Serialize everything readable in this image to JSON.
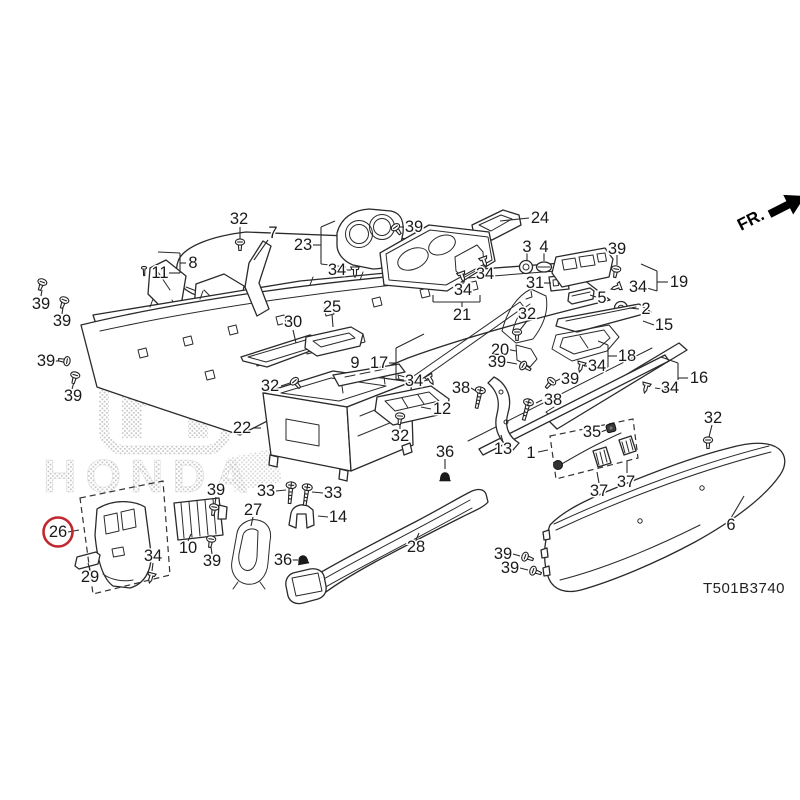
{
  "watermark": {
    "brand": "HONDA"
  },
  "orientation_label": "FR.",
  "diagram_code": "T501B3740",
  "highlighted_part": {
    "number": "26",
    "ring_color": "#c1272d"
  },
  "colors": {
    "line": "#2a2a2a",
    "label": "#1a1a1a",
    "watermark_dot": "#c9c9c9",
    "highlight": "#c1272d"
  },
  "diagram": {
    "labels": [
      {
        "t": "32",
        "x": 239,
        "y": 219
      },
      {
        "t": "7",
        "x": 273,
        "y": 233
      },
      {
        "t": "23",
        "x": 303,
        "y": 245
      },
      {
        "t": "39",
        "x": 414,
        "y": 227
      },
      {
        "t": "24",
        "x": 540,
        "y": 218
      },
      {
        "t": "3",
        "x": 527,
        "y": 247
      },
      {
        "t": "4",
        "x": 544,
        "y": 247
      },
      {
        "t": "39",
        "x": 617,
        "y": 249
      },
      {
        "t": "8",
        "x": 193,
        "y": 263
      },
      {
        "t": "11",
        "x": 160,
        "y": 273
      },
      {
        "t": "34",
        "x": 337,
        "y": 270
      },
      {
        "t": "34",
        "x": 485,
        "y": 274
      },
      {
        "t": "19",
        "x": 679,
        "y": 282
      },
      {
        "t": "31",
        "x": 535,
        "y": 283
      },
      {
        "t": "34",
        "x": 638,
        "y": 287
      },
      {
        "t": "34",
        "x": 463,
        "y": 290
      },
      {
        "t": "5",
        "x": 602,
        "y": 298
      },
      {
        "t": "2",
        "x": 646,
        "y": 309
      },
      {
        "t": "39",
        "x": 41,
        "y": 304
      },
      {
        "t": "25",
        "x": 332,
        "y": 307
      },
      {
        "t": "21",
        "x": 462,
        "y": 315
      },
      {
        "t": "32",
        "x": 527,
        "y": 314
      },
      {
        "t": "39",
        "x": 62,
        "y": 321
      },
      {
        "t": "30",
        "x": 293,
        "y": 322
      },
      {
        "t": "15",
        "x": 664,
        "y": 325
      },
      {
        "t": "20",
        "x": 500,
        "y": 350
      },
      {
        "t": "18",
        "x": 627,
        "y": 356
      },
      {
        "t": "39",
        "x": 46,
        "y": 361
      },
      {
        "t": "9",
        "x": 355,
        "y": 363
      },
      {
        "t": "17",
        "x": 379,
        "y": 363
      },
      {
        "t": "39",
        "x": 497,
        "y": 362
      },
      {
        "t": "34",
        "x": 597,
        "y": 366
      },
      {
        "t": "16",
        "x": 699,
        "y": 378
      },
      {
        "t": "39",
        "x": 570,
        "y": 379
      },
      {
        "t": "34",
        "x": 414,
        "y": 381
      },
      {
        "t": "32",
        "x": 270,
        "y": 386
      },
      {
        "t": "38",
        "x": 461,
        "y": 388
      },
      {
        "t": "34",
        "x": 670,
        "y": 388
      },
      {
        "t": "39",
        "x": 73,
        "y": 396
      },
      {
        "t": "38",
        "x": 553,
        "y": 400
      },
      {
        "t": "12",
        "x": 442,
        "y": 409
      },
      {
        "t": "32",
        "x": 713,
        "y": 418
      },
      {
        "t": "22",
        "x": 242,
        "y": 428
      },
      {
        "t": "35",
        "x": 592,
        "y": 432
      },
      {
        "t": "32",
        "x": 400,
        "y": 436
      },
      {
        "t": "13",
        "x": 503,
        "y": 449
      },
      {
        "t": "36",
        "x": 445,
        "y": 452
      },
      {
        "t": "1",
        "x": 531,
        "y": 453
      },
      {
        "t": "37",
        "x": 626,
        "y": 482
      },
      {
        "t": "37",
        "x": 599,
        "y": 491
      },
      {
        "t": "39",
        "x": 216,
        "y": 490
      },
      {
        "t": "33",
        "x": 266,
        "y": 491
      },
      {
        "t": "33",
        "x": 333,
        "y": 493
      },
      {
        "t": "27",
        "x": 253,
        "y": 510
      },
      {
        "t": "14",
        "x": 338,
        "y": 517
      },
      {
        "t": "6",
        "x": 731,
        "y": 525
      },
      {
        "t": "26",
        "x": 58,
        "y": 532,
        "circled": true
      },
      {
        "t": "28",
        "x": 416,
        "y": 547
      },
      {
        "t": "10",
        "x": 188,
        "y": 548
      },
      {
        "t": "39",
        "x": 503,
        "y": 554
      },
      {
        "t": "34",
        "x": 153,
        "y": 556
      },
      {
        "t": "36",
        "x": 283,
        "y": 560
      },
      {
        "t": "39",
        "x": 510,
        "y": 568
      },
      {
        "t": "29",
        "x": 90,
        "y": 577
      },
      {
        "t": "39",
        "x": 212,
        "y": 561
      }
    ],
    "leaders": [
      [
        240,
        227,
        240,
        240
      ],
      [
        268,
        240,
        254,
        260
      ],
      [
        313,
        245,
        321,
        245
      ],
      [
        321,
        227,
        321,
        264
      ],
      [
        321,
        227,
        335,
        221
      ],
      [
        321,
        264,
        346,
        267
      ],
      [
        404,
        227,
        399,
        227
      ],
      [
        529,
        218,
        500,
        221
      ],
      [
        527,
        253,
        527,
        261
      ],
      [
        544,
        253,
        544,
        261
      ],
      [
        617,
        255,
        617,
        265
      ],
      [
        186,
        263,
        180,
        263
      ],
      [
        180,
        253,
        180,
        273
      ],
      [
        180,
        253,
        158,
        252
      ],
      [
        180,
        273,
        169,
        273
      ],
      [
        346,
        270,
        351,
        270
      ],
      [
        485,
        268,
        485,
        264
      ],
      [
        463,
        284,
        463,
        279
      ],
      [
        433,
        302,
        480,
        302
      ],
      [
        462,
        302,
        462,
        307
      ],
      [
        433,
        302,
        433,
        295
      ],
      [
        480,
        302,
        480,
        295
      ],
      [
        544,
        283,
        551,
        283
      ],
      [
        596,
        297,
        590,
        295
      ],
      [
        639,
        309,
        629,
        308
      ],
      [
        668,
        282,
        657,
        282
      ],
      [
        657,
        271,
        657,
        291
      ],
      [
        657,
        271,
        641,
        264
      ],
      [
        657,
        291,
        647,
        288
      ],
      [
        41,
        296,
        42,
        290
      ],
      [
        62,
        314,
        63,
        307
      ],
      [
        54,
        361,
        60,
        361
      ],
      [
        72,
        389,
        74,
        382
      ],
      [
        654,
        325,
        643,
        321
      ],
      [
        332,
        314,
        333,
        327
      ],
      [
        293,
        330,
        296,
        343
      ],
      [
        527,
        321,
        520,
        330
      ],
      [
        506,
        349,
        516,
        351
      ],
      [
        617,
        356,
        608,
        356
      ],
      [
        608,
        345,
        608,
        367
      ],
      [
        608,
        345,
        598,
        341
      ],
      [
        608,
        367,
        590,
        366
      ],
      [
        506,
        362,
        517,
        364
      ],
      [
        688,
        378,
        678,
        378
      ],
      [
        678,
        363,
        678,
        391
      ],
      [
        678,
        363,
        661,
        357
      ],
      [
        678,
        391,
        655,
        388
      ],
      [
        560,
        379,
        556,
        381
      ],
      [
        281,
        386,
        290,
        383
      ],
      [
        424,
        381,
        428,
        380
      ],
      [
        587,
        366,
        584,
        366
      ],
      [
        471,
        388,
        476,
        391
      ],
      [
        542,
        400,
        536,
        403
      ],
      [
        431,
        409,
        421,
        407
      ],
      [
        253,
        428,
        261,
        428
      ],
      [
        400,
        429,
        400,
        423
      ],
      [
        712,
        425,
        709,
        437
      ],
      [
        601,
        432,
        606,
        430
      ],
      [
        445,
        459,
        445,
        469
      ],
      [
        503,
        442,
        501,
        435
      ],
      [
        538,
        452,
        548,
        450
      ],
      [
        627,
        473,
        627,
        461
      ],
      [
        599,
        483,
        597,
        472
      ],
      [
        216,
        497,
        215,
        504
      ],
      [
        276,
        491,
        286,
        490
      ],
      [
        323,
        493,
        312,
        492
      ],
      [
        253,
        517,
        251,
        526
      ],
      [
        328,
        517,
        318,
        516
      ],
      [
        68,
        532,
        79,
        530
      ],
      [
        188,
        541,
        191,
        534
      ],
      [
        416,
        540,
        419,
        533
      ],
      [
        153,
        563,
        152,
        571
      ],
      [
        292,
        560,
        298,
        560
      ],
      [
        212,
        554,
        211,
        547
      ],
      [
        90,
        570,
        88,
        563
      ],
      [
        731,
        518,
        744,
        496
      ],
      [
        513,
        554,
        520,
        556
      ],
      [
        520,
        568,
        528,
        570
      ],
      [
        389,
        363,
        396,
        363
      ],
      [
        396,
        348,
        396,
        379
      ],
      [
        396,
        348,
        424,
        334
      ],
      [
        396,
        379,
        404,
        380
      ]
    ],
    "fasteners": [
      {
        "t": "screw",
        "x": 240,
        "y": 243,
        "r": 0
      },
      {
        "t": "screw",
        "x": 42,
        "y": 283,
        "r": 20
      },
      {
        "t": "screw",
        "x": 64,
        "y": 301,
        "r": 20
      },
      {
        "t": "screw",
        "x": 66,
        "y": 361,
        "r": 100
      },
      {
        "t": "screw",
        "x": 75,
        "y": 376,
        "r": 15
      },
      {
        "t": "screw",
        "x": 396,
        "y": 228,
        "r": -35
      },
      {
        "t": "screw",
        "x": 616,
        "y": 270,
        "r": 10
      },
      {
        "t": "screw",
        "x": 524,
        "y": 366,
        "r": -60
      },
      {
        "t": "screw",
        "x": 551,
        "y": 382,
        "r": 40
      },
      {
        "t": "screw",
        "x": 214,
        "y": 508,
        "r": 10
      },
      {
        "t": "screw",
        "x": 211,
        "y": 540,
        "r": 10
      },
      {
        "t": "screw",
        "x": 526,
        "y": 557,
        "r": -70
      },
      {
        "t": "screw",
        "x": 534,
        "y": 571,
        "r": -70
      },
      {
        "t": "screw",
        "x": 295,
        "y": 382,
        "r": -40
      },
      {
        "t": "screw",
        "x": 400,
        "y": 417,
        "r": 5
      },
      {
        "t": "screw",
        "x": 517,
        "y": 333,
        "r": 0
      },
      {
        "t": "screw",
        "x": 708,
        "y": 441,
        "r": 0
      },
      {
        "t": "clip",
        "x": 355,
        "y": 271,
        "r": 0
      },
      {
        "t": "clip",
        "x": 484,
        "y": 261,
        "r": -20
      },
      {
        "t": "clip",
        "x": 462,
        "y": 276,
        "r": -20
      },
      {
        "t": "clip",
        "x": 430,
        "y": 379,
        "r": -30
      },
      {
        "t": "clip",
        "x": 581,
        "y": 366,
        "r": 15
      },
      {
        "t": "clip",
        "x": 617,
        "y": 287,
        "r": 70
      },
      {
        "t": "clip",
        "x": 646,
        "y": 387,
        "r": 15
      },
      {
        "t": "clip",
        "x": 151,
        "y": 577,
        "r": 15
      },
      {
        "t": "bolt",
        "x": 291,
        "y": 487,
        "r": 5
      },
      {
        "t": "bolt",
        "x": 307,
        "y": 489,
        "r": 8
      },
      {
        "t": "bolt",
        "x": 480,
        "y": 392,
        "r": 12
      },
      {
        "t": "bolt",
        "x": 528,
        "y": 404,
        "r": 15
      },
      {
        "t": "cone",
        "x": 445,
        "y": 477,
        "r": 0
      },
      {
        "t": "cone",
        "x": 303,
        "y": 560,
        "r": -10
      },
      {
        "t": "conn",
        "x": 611,
        "y": 428,
        "r": -15
      },
      {
        "t": "pin",
        "x": 144,
        "y": 271,
        "r": 0
      }
    ]
  }
}
